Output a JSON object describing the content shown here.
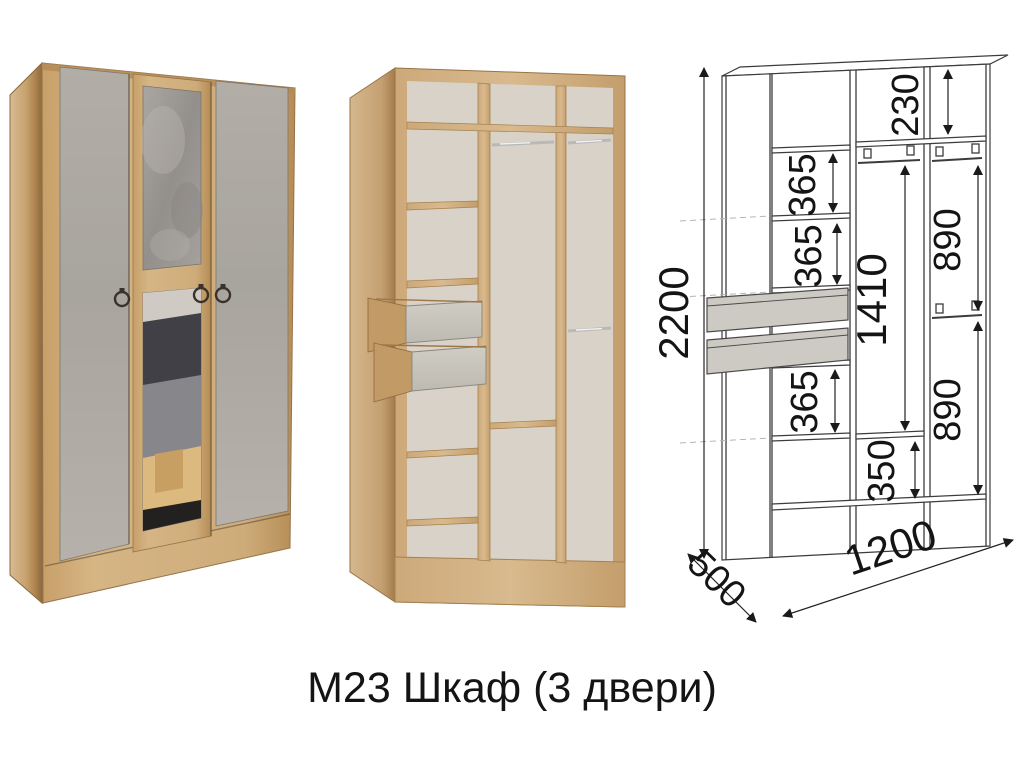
{
  "title": {
    "text": "М23 Шкаф (3 двери)"
  },
  "diagram": {
    "overall_height": "2200",
    "overall_width": "1200",
    "overall_depth": "500",
    "top_section": "230",
    "left_gaps": [
      "365",
      "365",
      "365"
    ],
    "middle_hanging": "1410",
    "middle_bottom": "350",
    "right_sections": [
      "890",
      "890"
    ]
  },
  "theme": {
    "background": "#ffffff",
    "line_color": "#3c3c3c",
    "text_color": "#141414",
    "oak": "#cfa878",
    "oak_light": "#dcc096",
    "oak_dark": "#a87f4f",
    "concrete": "#aeaaa4",
    "concrete_light": "#c9c6be",
    "mirror_gray": "#9b9894",
    "back_panel": "#d9d2c8"
  }
}
